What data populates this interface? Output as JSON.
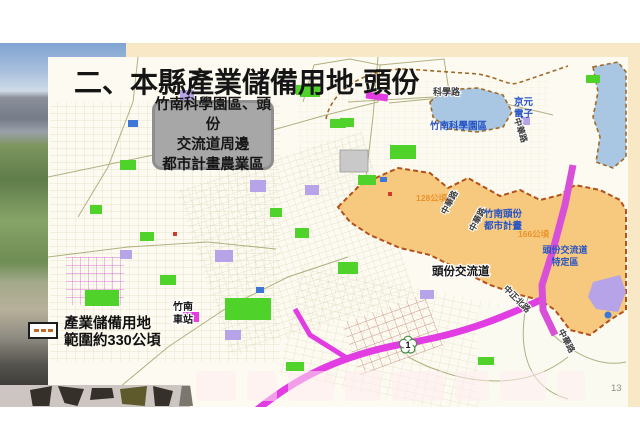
{
  "slide": {
    "title": "二、本縣產業儲備用地-頭份",
    "subtitle_lines": [
      "竹南科學園區、頭份",
      "交流道周邊",
      "都市計畫農業區"
    ],
    "page_number": "13"
  },
  "legend": {
    "line1": "產業儲備用地",
    "line2": "範圍約330公頃",
    "swatch": "dashed-boundary-icon"
  },
  "map": {
    "labels": {
      "science_road": "科學路",
      "kyec_line1": "京元",
      "kyec_line2": "電子",
      "zhunan_science_park": "竹南科學園區",
      "zhonghua_road_a": "中華路",
      "zhonghua_road_b": "中華路",
      "zhonghua_road_c": "中華路",
      "zhonghua_road_d": "中華路",
      "area_west": "128公頃",
      "area_east": "166公頃",
      "plan_line1": "竹南頭份",
      "plan_line2": "都市計畫",
      "toufen_interchange": "頭份交流道",
      "sda_line1": "頭份交流道",
      "sda_line2": "特定區",
      "station_line1": "竹南",
      "station_line2": "車站",
      "zhongzheng_n_road": "中正北路",
      "highway_shield": "1"
    },
    "colors": {
      "reserve_zone_fill": "#f7c97e",
      "reserve_zone_border": "#b3511c",
      "science_park_blue": "#a9c6e2",
      "green_zone": "#4fd32a",
      "purple_zone": "#b7a3e8",
      "highway_magenta": "#e23de2",
      "slide_backdrop_cream": "#f8e8c6"
    }
  }
}
